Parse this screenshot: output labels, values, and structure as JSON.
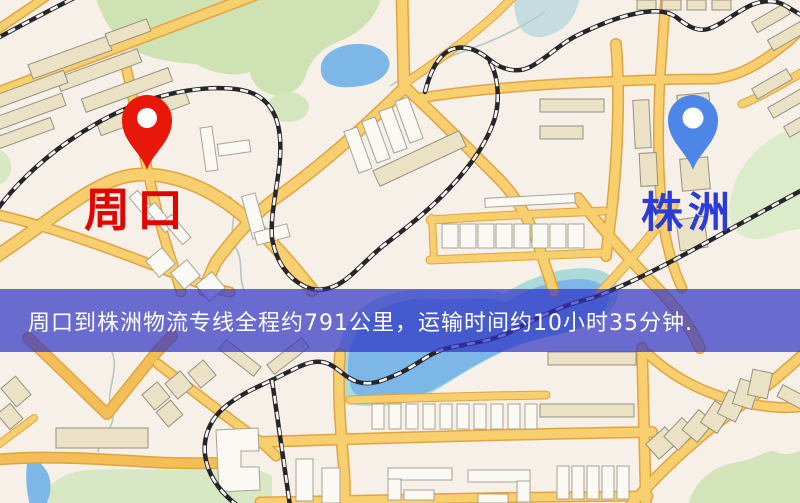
{
  "banner": {
    "text": "周口到株洲物流专线全程约791公里，运输时间约10小时35分钟.",
    "bg": "rgba(47,50,197,0.70)",
    "color": "#ffffff"
  },
  "markers": {
    "origin": {
      "label": "周口",
      "label_color": "#e00500",
      "pin_color": "#e8170a"
    },
    "destination": {
      "label": "株洲",
      "label_color": "#2b3cd8",
      "pin_color": "#4e86e8"
    }
  },
  "map_palette": {
    "background": "#f6f0e8",
    "road_fill": "#f7cf6e",
    "road_casing": "#e2a440",
    "water": "#7db7e8",
    "park": "#cfe2b4",
    "railway": "#26262a",
    "building": "#ebe2c6"
  }
}
